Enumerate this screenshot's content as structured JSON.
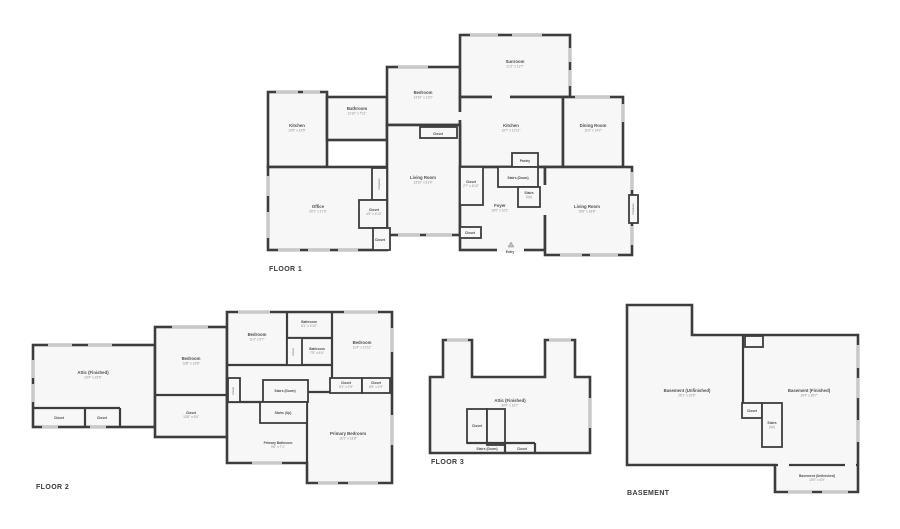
{
  "page": {
    "background": "#ffffff",
    "wall_color": "#3d3d3d",
    "room_fill": "#f7f7f7",
    "window_color": "#c9c9c9",
    "text_color": "#4f4f4f"
  },
  "floors": [
    {
      "id": "floor-1",
      "label": "FLOOR 1",
      "rooms": [
        {
          "name": "Kitchen",
          "dims": "10'9\" x 14'5\"",
          "x": 297,
          "y": 127
        },
        {
          "name": "Bathroom",
          "dims": "11'10\" x 7'11\"",
          "x": 357,
          "y": 110
        },
        {
          "name": "Bedroom",
          "dims": "13'10\" x 11'0\"",
          "x": 423,
          "y": 94
        },
        {
          "name": "Closet",
          "dims": "",
          "x": 438,
          "y": 135,
          "size": "s"
        },
        {
          "name": "Sunroom",
          "dims": "21'2\" x 11'7\"",
          "x": 515,
          "y": 63
        },
        {
          "name": "Kitchen",
          "dims": "15'7\" x 12'11\"",
          "x": 511,
          "y": 127
        },
        {
          "name": "Dining Room",
          "dims": "11'6\" x 14'2\"",
          "x": 593,
          "y": 127
        },
        {
          "name": "Pantry",
          "dims": "",
          "x": 525,
          "y": 162,
          "size": "s"
        },
        {
          "name": "Stairs (Down)",
          "dims": "",
          "x": 518,
          "y": 179,
          "size": "s"
        },
        {
          "name": "Stairs",
          "dims": "(Up)",
          "x": 529,
          "y": 194,
          "size": "s"
        },
        {
          "name": "Closet",
          "dims": "2'7\" x 6'10\"",
          "x": 471,
          "y": 183,
          "size": "s"
        },
        {
          "name": "Foyer",
          "dims": "10'0\" x 10'1\"",
          "x": 500,
          "y": 207
        },
        {
          "name": "Living Room",
          "dims": "13'10\" x 21'4\"",
          "x": 423,
          "y": 179
        },
        {
          "name": "Office",
          "dims": "20'1\" x 17'3\"",
          "x": 318,
          "y": 208
        },
        {
          "name": "Closet",
          "dims": "4'5\" x 4'10\"",
          "x": 374,
          "y": 211,
          "size": "s"
        },
        {
          "name": "Closet",
          "dims": "",
          "x": 380,
          "y": 241,
          "size": "s"
        },
        {
          "name": "Closet",
          "dims": "",
          "x": 470,
          "y": 234,
          "size": "s"
        },
        {
          "name": "Living Room",
          "dims": "16'6\" x 18'8\"",
          "x": 587,
          "y": 208
        },
        {
          "name": "Fireplace",
          "dims": "",
          "x": 380,
          "y": 184,
          "rotate": true,
          "size": "f"
        },
        {
          "name": "Fireplace",
          "dims": "",
          "x": 634,
          "y": 209,
          "rotate": true,
          "size": "f"
        },
        {
          "name": "Entry",
          "dims": "",
          "x": 510,
          "y": 253,
          "size": "s"
        }
      ]
    },
    {
      "id": "floor-2",
      "label": "FLOOR 2",
      "rooms": [
        {
          "name": "Attic (Finished)",
          "dims": "23'4\" x 15'6\"",
          "x": 93,
          "y": 374
        },
        {
          "name": "Closet",
          "dims": "",
          "x": 59,
          "y": 419,
          "size": "s"
        },
        {
          "name": "Closet",
          "dims": "",
          "x": 102,
          "y": 419,
          "size": "s"
        },
        {
          "name": "Bedroom",
          "dims": "13'8\" x 13'8\"",
          "x": 191,
          "y": 360
        },
        {
          "name": "Closet",
          "dims": "13'8\" x 6'0\"",
          "x": 191,
          "y": 414,
          "size": "s"
        },
        {
          "name": "Bedroom",
          "dims": "11'4\" x 9'7\"",
          "x": 257,
          "y": 336
        },
        {
          "name": "Bathroom",
          "dims": "8'1\" x 4'10\"",
          "x": 309,
          "y": 323,
          "size": "s"
        },
        {
          "name": "Closet",
          "dims": "",
          "x": 294,
          "y": 352,
          "rotate": true,
          "size": "f"
        },
        {
          "name": "Bathroom",
          "dims": "7'5\" x 6'4\"",
          "x": 317,
          "y": 350,
          "size": "s"
        },
        {
          "name": "Bedroom",
          "dims": "11'4\" x 12'11\"",
          "x": 362,
          "y": 344
        },
        {
          "name": "Stairs (Down)",
          "dims": "",
          "x": 285,
          "y": 392,
          "size": "s"
        },
        {
          "name": "Stairs (Up)",
          "dims": "",
          "x": 283,
          "y": 414,
          "size": "s"
        },
        {
          "name": "Closet",
          "dims": "5'1\" x 2'9\"",
          "x": 346,
          "y": 384,
          "size": "s"
        },
        {
          "name": "Closet",
          "dims": "5'5\" x 2'9\"",
          "x": 376,
          "y": 384,
          "size": "s"
        },
        {
          "name": "Closet",
          "dims": "",
          "x": 234,
          "y": 391,
          "rotate": true,
          "size": "f"
        },
        {
          "name": "Primary Bathroom",
          "dims": "9'6\" x 7'1\"",
          "x": 278,
          "y": 444,
          "size": "s"
        },
        {
          "name": "Primary Bedroom",
          "dims": "16'1\" x 13'8\"",
          "x": 348,
          "y": 435
        }
      ]
    },
    {
      "id": "floor-3",
      "label": "FLOOR 3",
      "rooms": [
        {
          "name": "Attic (Finished)",
          "dims": "30'0\" x 13'7\"",
          "x": 510,
          "y": 402
        },
        {
          "name": "Closet",
          "dims": "",
          "x": 477,
          "y": 427,
          "size": "s"
        },
        {
          "name": "Stairs (Down)",
          "dims": "",
          "x": 487,
          "y": 450,
          "size": "s"
        },
        {
          "name": "Closet",
          "dims": "",
          "x": 522,
          "y": 450,
          "size": "s"
        }
      ]
    },
    {
      "id": "basement",
      "label": "BASEMENT",
      "rooms": [
        {
          "name": "Basement (Unfinished)",
          "dims": "26'1\" x 22'5\"",
          "x": 687,
          "y": 392
        },
        {
          "name": "Basement (Finished)",
          "dims": "19'4\" x 26'7\"",
          "x": 809,
          "y": 392
        },
        {
          "name": "Closet",
          "dims": "",
          "x": 752,
          "y": 412,
          "size": "s"
        },
        {
          "name": "Stairs",
          "dims": "(Up)",
          "x": 772,
          "y": 424,
          "size": "s"
        },
        {
          "name": "Basement (Unfinished)",
          "dims": "15'9\" x 6'9\"",
          "x": 817,
          "y": 477,
          "size": "s"
        }
      ]
    }
  ]
}
